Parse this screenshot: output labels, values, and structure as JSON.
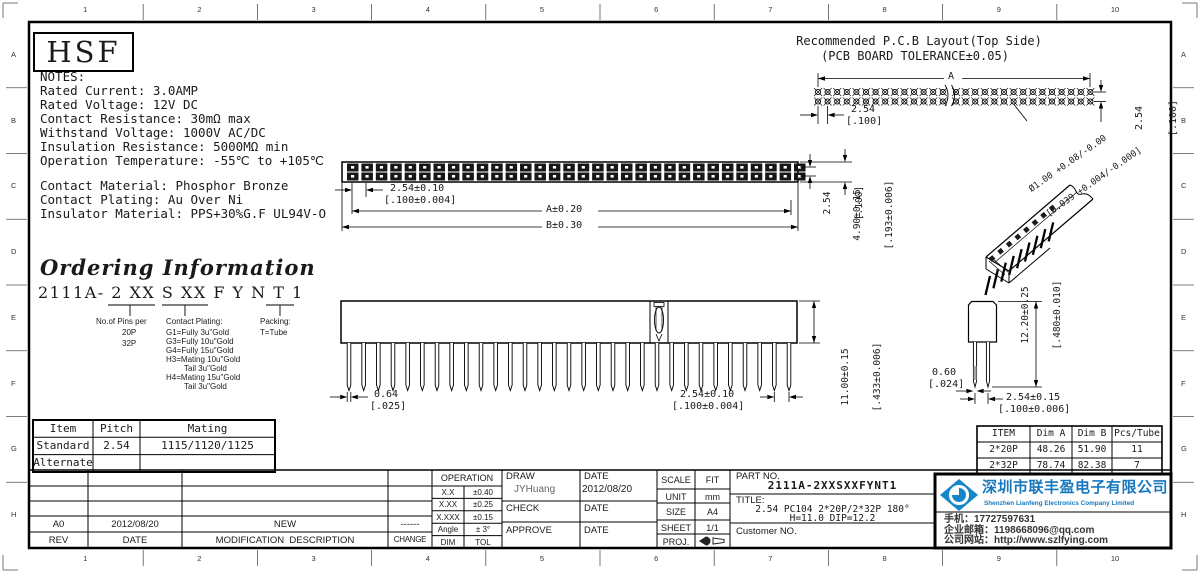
{
  "sheet": {
    "cols": [
      "1",
      "2",
      "3",
      "4",
      "5",
      "6",
      "7",
      "8",
      "9",
      "10"
    ],
    "rows": [
      "A",
      "B",
      "C",
      "D",
      "E",
      "F",
      "G",
      "H"
    ]
  },
  "logo_text": "HSF",
  "notes": {
    "lines": [
      "NOTES:",
      "Rated Current: 3.0AMP",
      "Rated Voltage: 12V DC",
      "Contact Resistance: 30mΩ max",
      "Withstand Voltage: 1000V AC/DC",
      "Insulation Resistance: 5000MΩ min",
      "Operation Temperature: -55℃ to +105℃",
      "",
      "Contact Material: Phosphor Bronze",
      "Contact Plating: Au Over Ni",
      "Insulator Material: PPS+30%G.F UL94V-O"
    ]
  },
  "pcb_layout": {
    "title_line1": "Recommended P.C.B Layout(Top Side)",
    "title_line2": "(PCB BOARD TOLERANCE±0.05)",
    "dim_a": "A",
    "pad_pitch_mm": "2.54",
    "pad_pitch_in": "[.100]",
    "row_pitch_mm": "2.54",
    "row_pitch_in": "[.100]",
    "hole_mm": "Ø1.00 +0.08/-0.00",
    "hole_in": "[Ø.039 +0.004/-0.000]"
  },
  "top_view": {
    "pitch_mm": "2.54±0.10",
    "pitch_in": "[.100±0.004]",
    "dim_a": "A±0.20",
    "dim_b": "B±0.30",
    "row_pitch_mm": "2.54",
    "row_pitch_in": "[.100]",
    "height_mm": "4.90±0.15",
    "height_in": "[.193±0.006]"
  },
  "ordering": {
    "title": "Ordering Information",
    "code": "2111A- 2 XX S XX F Y N T 1",
    "pins_label": "No.of Pins per",
    "pins_options": [
      "20P",
      "32P"
    ],
    "plating_label": "Contact Plating:",
    "plating_options": [
      "G1=Fully 3u\"Gold",
      "G3=Fully 10u\"Gold",
      "G4=Fully 15u\"Gold",
      "H3=Mating 10u\"Gold",
      "Tail 3u\"Gold",
      "H4=Mating 15u\"Gold",
      "Tail 3u\"Gold"
    ],
    "packing_label": "Packing:",
    "packing_option": "T=Tube"
  },
  "front_view": {
    "pin_w_mm": "0.64",
    "pin_w_in": "[.025]",
    "pitch_mm": "2.54±0.10",
    "pitch_in": "[.100±0.004]",
    "height_mm": "11.00±0.15",
    "height_in": "[.433±0.006]"
  },
  "side_view": {
    "total_h_mm": "12.20±0.25",
    "total_h_in": "[.480±0.010]",
    "pin_t_mm": "0.60",
    "pin_t_in": "[.024]",
    "row_pitch_mm": "2.54±0.15",
    "row_pitch_in": "[.100±0.006]"
  },
  "mating_table": {
    "headers": [
      "Item",
      "Pitch",
      "Mating"
    ],
    "rows": [
      [
        "Standard",
        "2.54",
        "1115/1120/1125"
      ],
      [
        "Alternate",
        "",
        ""
      ]
    ]
  },
  "pcs_table": {
    "headers": [
      "ITEM",
      "Dim A",
      "Dim B",
      "Pcs/Tube"
    ],
    "rows": [
      [
        "2*20P",
        "48.26",
        "51.90",
        "11"
      ],
      [
        "2*32P",
        "78.74",
        "82.38",
        "7"
      ]
    ]
  },
  "revision_table": {
    "entry": {
      "rev": "A0",
      "date": "2012/08/20",
      "desc": "NEW",
      "change": "------"
    },
    "headers": [
      "REV",
      "DATE",
      "MODIFICATION  DESCRIPTION",
      "CHANGE"
    ]
  },
  "title_block": {
    "operation_label": "OPERATION",
    "tolerances": [
      [
        "X.X",
        "±0.40"
      ],
      [
        "X.XX",
        "±0.25"
      ],
      [
        "X.XXX",
        "±0.15"
      ],
      [
        "Angle",
        "± 3°"
      ],
      [
        "DIM",
        "TOL"
      ]
    ],
    "draw_label": "DRAW",
    "draw_name": "JYHuang",
    "date_label": "DATE",
    "draw_date": "2012/08/20",
    "check_label": "CHECK",
    "approve_label": "APPROVE",
    "scale_label": "SCALE",
    "scale_value": "FIT",
    "unit_label": "UNIT",
    "unit_value": "mm",
    "size_label": "SIZE",
    "size_value": "A4",
    "sheet_label": "SHEET",
    "sheet_value": "1/1",
    "proj_label": "PROJ.",
    "part_no_label": "PART NO.",
    "part_no": "2111A-2XXSXXFYNT1",
    "title_label": "TITLE:",
    "title_line1": "2.54 PC104 2*20P/2*32P 180°",
    "title_line2": "H=11.0 DIP=12.2",
    "customer_label": "Customer NO."
  },
  "company": {
    "name_cn": "深圳市联丰盈电子有限公司",
    "name_en": "Shenzhen Lianfeng Electronics Company Limited",
    "phone": "手机：17727597631",
    "email": "企业邮箱：1198668096@qq.com",
    "website": "公司网站：http://www.szlfying.com",
    "brand_color": "#1778be"
  }
}
